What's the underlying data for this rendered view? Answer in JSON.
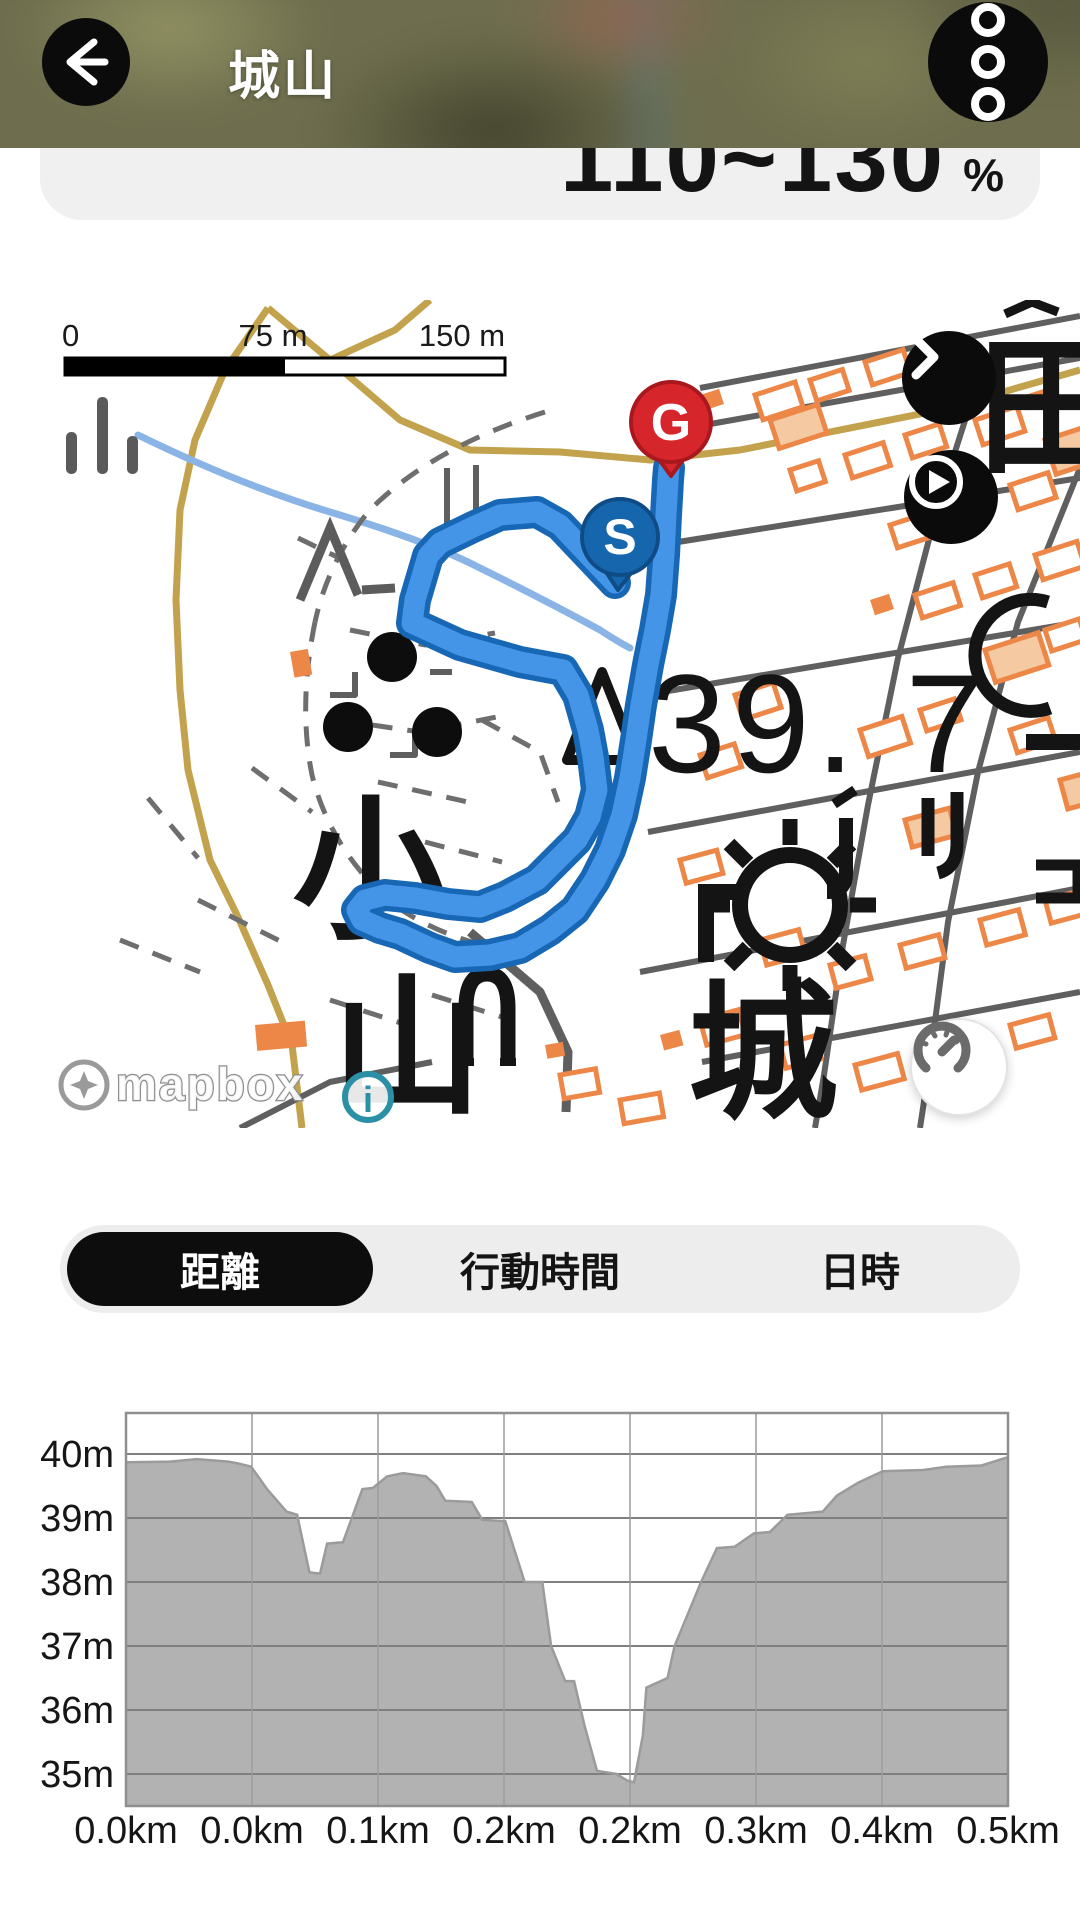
{
  "header": {
    "title": "城山",
    "back_icon": "arrow-left-icon",
    "menu_icon": "kebab-menu-icon"
  },
  "stat_card": {
    "value": "110~130",
    "unit": "%"
  },
  "map": {
    "scale_bar": {
      "start": "0",
      "mid": "75 m",
      "end": "150 m"
    },
    "labels": {
      "hill_left_top": "小",
      "hill_left_bottom": "山",
      "castle": "城",
      "field": "田",
      "spot_elevation": "39. 7"
    },
    "markers": {
      "start_label": "S",
      "start_color": "#1566ad",
      "start_border": "#0f4c85",
      "goal_label": "G",
      "goal_color": "#d7262b",
      "goal_border": "#a8181e"
    },
    "route": {
      "stroke": "#4495e8",
      "border": "#1767b5",
      "points": [
        [
          615,
          283
        ],
        [
          560,
          225
        ],
        [
          537,
          212
        ],
        [
          500,
          215
        ],
        [
          473,
          227
        ],
        [
          440,
          243
        ],
        [
          428,
          256
        ],
        [
          415,
          300
        ],
        [
          412,
          323
        ],
        [
          460,
          345
        ],
        [
          520,
          362
        ],
        [
          563,
          370
        ],
        [
          578,
          395
        ],
        [
          588,
          430
        ],
        [
          593,
          457
        ],
        [
          597,
          490
        ],
        [
          590,
          517
        ],
        [
          577,
          540
        ],
        [
          555,
          562
        ],
        [
          537,
          580
        ],
        [
          505,
          597
        ],
        [
          480,
          607
        ],
        [
          448,
          604
        ],
        [
          415,
          598
        ],
        [
          385,
          595
        ],
        [
          365,
          600
        ],
        [
          357,
          610
        ],
        [
          362,
          620
        ],
        [
          380,
          628
        ],
        [
          400,
          634
        ],
        [
          430,
          648
        ],
        [
          455,
          657
        ],
        [
          490,
          655
        ],
        [
          520,
          648
        ],
        [
          550,
          630
        ],
        [
          575,
          610
        ],
        [
          595,
          580
        ],
        [
          610,
          550
        ],
        [
          622,
          515
        ],
        [
          630,
          478
        ],
        [
          636,
          440
        ],
        [
          641,
          405
        ],
        [
          648,
          365
        ],
        [
          655,
          330
        ],
        [
          661,
          295
        ],
        [
          664,
          255
        ],
        [
          666,
          215
        ],
        [
          668,
          180
        ],
        [
          669,
          168
        ]
      ]
    },
    "attribution": {
      "brand": "mapbox",
      "info_label": "i"
    }
  },
  "tabs": {
    "items": [
      {
        "label": "距離",
        "selected": true
      },
      {
        "label": "行動時間",
        "selected": false
      },
      {
        "label": "日時",
        "selected": false
      }
    ]
  },
  "chart_data": {
    "type": "area",
    "title": "",
    "xlabel": "",
    "ylabel": "",
    "x_ticks": [
      "0.0km",
      "0.0km",
      "0.1km",
      "0.2km",
      "0.2km",
      "0.3km",
      "0.4km",
      "0.5km"
    ],
    "y_ticks": [
      {
        "label": "40m",
        "value": 40
      },
      {
        "label": "39m",
        "value": 39
      },
      {
        "label": "38m",
        "value": 38
      },
      {
        "label": "37m",
        "value": 37
      },
      {
        "label": "36m",
        "value": 36
      },
      {
        "label": "35m",
        "value": 35
      }
    ],
    "xlim": [
      0,
      0.5
    ],
    "ylim": [
      34.5,
      40.64
    ],
    "grid": true,
    "legend": false,
    "fill_color": "#b2b2b2",
    "profile": [
      [
        0.0,
        39.87
      ],
      [
        0.025,
        39.88
      ],
      [
        0.04,
        39.92
      ],
      [
        0.058,
        39.88
      ],
      [
        0.064,
        39.85
      ],
      [
        0.071,
        39.8
      ],
      [
        0.08,
        39.45
      ],
      [
        0.091,
        39.1
      ],
      [
        0.097,
        39.05
      ],
      [
        0.104,
        38.15
      ],
      [
        0.11,
        38.13
      ],
      [
        0.114,
        38.6
      ],
      [
        0.123,
        38.62
      ],
      [
        0.134,
        39.45
      ],
      [
        0.14,
        39.47
      ],
      [
        0.148,
        39.65
      ],
      [
        0.157,
        39.7
      ],
      [
        0.17,
        39.65
      ],
      [
        0.176,
        39.5
      ],
      [
        0.181,
        39.27
      ],
      [
        0.196,
        39.25
      ],
      [
        0.202,
        38.97
      ],
      [
        0.215,
        38.95
      ],
      [
        0.226,
        38.0
      ],
      [
        0.236,
        38.0
      ],
      [
        0.241,
        37.0
      ],
      [
        0.249,
        36.45
      ],
      [
        0.254,
        36.45
      ],
      [
        0.26,
        35.75
      ],
      [
        0.267,
        35.05
      ],
      [
        0.278,
        35.0
      ],
      [
        0.284,
        34.9
      ],
      [
        0.288,
        34.87
      ],
      [
        0.293,
        35.6
      ],
      [
        0.295,
        36.35
      ],
      [
        0.307,
        36.5
      ],
      [
        0.311,
        37.0
      ],
      [
        0.32,
        37.6
      ],
      [
        0.326,
        38.0
      ],
      [
        0.335,
        38.53
      ],
      [
        0.345,
        38.55
      ],
      [
        0.356,
        38.76
      ],
      [
        0.365,
        38.78
      ],
      [
        0.375,
        39.05
      ],
      [
        0.395,
        39.1
      ],
      [
        0.403,
        39.35
      ],
      [
        0.415,
        39.55
      ],
      [
        0.429,
        39.73
      ],
      [
        0.452,
        39.75
      ],
      [
        0.465,
        39.8
      ],
      [
        0.485,
        39.82
      ],
      [
        0.5,
        39.95
      ]
    ]
  }
}
